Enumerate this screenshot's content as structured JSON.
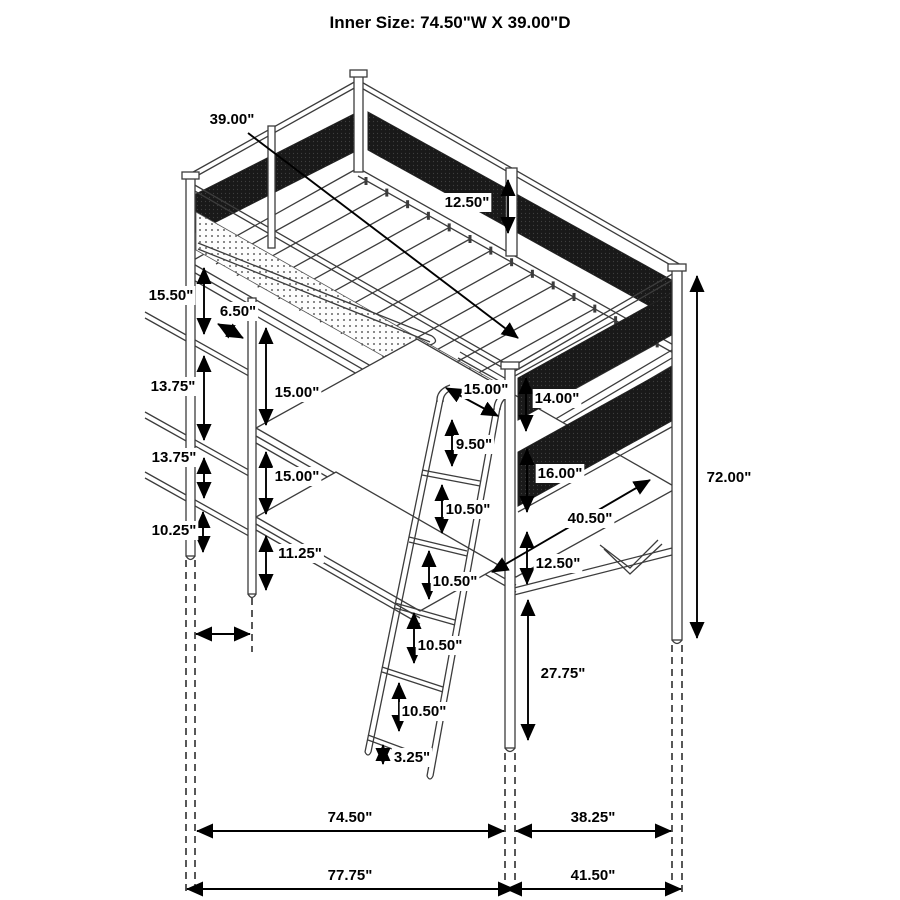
{
  "title": "Inner Size: 74.50\"W X 39.00\"D",
  "diagram_type": "loft-bed-with-desk-dimension-drawing",
  "colors": {
    "line": "#3c3c3c",
    "dimension": "#000000",
    "mesh_panel": "#191919",
    "background": "#ffffff"
  },
  "dims": {
    "inner_depth": "39.00\"",
    "guardrail_height": "12.50\"",
    "top_shelf_gap": "15.50\"",
    "shelf_offset_depth": "6.50\"",
    "shelf_gap_upper": "13.75\"",
    "desk_to_bunk_left": "15.00\"",
    "shelf_gap_lower": "13.75\"",
    "desk_to_shelf_left": "15.00\"",
    "bottom_shelf_gap": "10.25\"",
    "lower_shelf_height": "11.25\"",
    "rail_to_post": "15.00\"",
    "ladder_top_spacing": "9.50\"",
    "panel_upper_height": "14.00\"",
    "panel_lower_height": "16.00\"",
    "desktop_width": "40.50\"",
    "desk_shelf_gap": "12.50\"",
    "rung_spacing_1": "10.50\"",
    "rung_spacing_2": "10.50\"",
    "rung_spacing_3": "10.50\"",
    "rung_spacing_4": "10.50\"",
    "desk_floor_clearance": "27.75\"",
    "ladder_bottom_offset": "3.25\"",
    "overall_height": "72.00\"",
    "bed_inner_width": "74.50\"",
    "end_inner_depth": "38.25\"",
    "bed_outer_width": "77.75\"",
    "end_outer_depth": "41.50\""
  }
}
